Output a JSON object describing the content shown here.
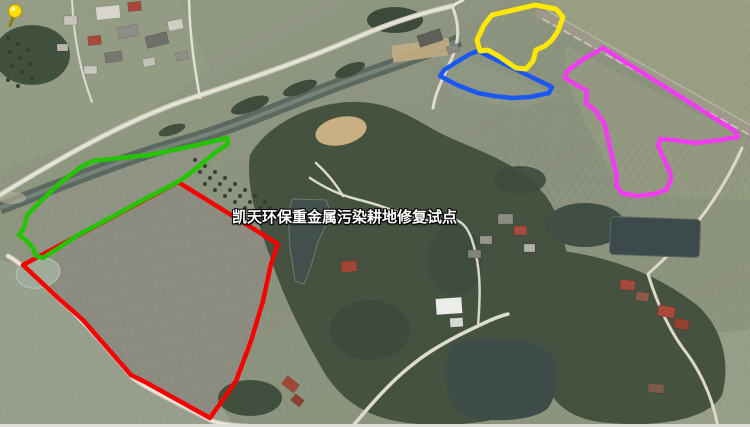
{
  "window": {
    "width": 750,
    "height": 427,
    "type": "satellite-map-screenshot"
  },
  "map": {
    "imagery": "rural aerial/satellite view with fields, forest, river, roads, ponds and villages",
    "label": {
      "text": "凯天环保重金属污染耕地修复试点",
      "text_color": "#ffffff",
      "outline_color": "#000000"
    },
    "pin": {
      "name": "site-pushpin",
      "head_color": "#ffe000",
      "stem_color": "#8a7a00"
    },
    "annotations": [
      {
        "name": "red-plot-outline",
        "color": "#f60000",
        "stroke_width": 4.5,
        "points": [
          [
            178,
            182
          ],
          [
            278,
            244
          ],
          [
            271,
            264
          ],
          [
            263,
            301
          ],
          [
            251,
            341
          ],
          [
            236,
            381
          ],
          [
            210,
            418
          ],
          [
            147,
            383
          ],
          [
            131,
            375
          ],
          [
            83,
            320
          ],
          [
            57,
            297
          ],
          [
            23,
            265
          ]
        ]
      },
      {
        "name": "green-plot-outline",
        "color": "#24c400",
        "stroke_width": 4.5,
        "points": [
          [
            227,
            138
          ],
          [
            197,
            145
          ],
          [
            150,
            155
          ],
          [
            120,
            158
          ],
          [
            93,
            161
          ],
          [
            81,
            167
          ],
          [
            60,
            183
          ],
          [
            42,
            200
          ],
          [
            27,
            215
          ],
          [
            24,
            228
          ],
          [
            19,
            235
          ],
          [
            27,
            241
          ],
          [
            33,
            248
          ],
          [
            36,
            256
          ],
          [
            43,
            258
          ],
          [
            60,
            247
          ],
          [
            78,
            235
          ],
          [
            110,
            218
          ],
          [
            143,
            200
          ],
          [
            170,
            186
          ],
          [
            181,
            180
          ],
          [
            198,
            167
          ],
          [
            216,
            152
          ],
          [
            228,
            144
          ]
        ]
      },
      {
        "name": "blue-plot-outline",
        "color": "#1b57f2",
        "stroke_width": 4.5,
        "points": [
          [
            478,
            51
          ],
          [
            552,
            87
          ],
          [
            549,
            93
          ],
          [
            530,
            97
          ],
          [
            512,
            98
          ],
          [
            494,
            96
          ],
          [
            478,
            93
          ],
          [
            457,
            85
          ],
          [
            440,
            76
          ],
          [
            444,
            70
          ],
          [
            460,
            60
          ],
          [
            470,
            54
          ]
        ]
      },
      {
        "name": "yellow-plot-outline",
        "color": "#ffe800",
        "stroke_width": 5,
        "points": [
          [
            492,
            15
          ],
          [
            535,
            5
          ],
          [
            556,
            9
          ],
          [
            563,
            17
          ],
          [
            558,
            31
          ],
          [
            552,
            40
          ],
          [
            545,
            46
          ],
          [
            536,
            50
          ],
          [
            533,
            61
          ],
          [
            526,
            69
          ],
          [
            516,
            68
          ],
          [
            500,
            57
          ],
          [
            488,
            50
          ],
          [
            480,
            51
          ],
          [
            477,
            40
          ],
          [
            484,
            25
          ]
        ]
      },
      {
        "name": "magenta-plot-outline",
        "color": "#f23cf2",
        "stroke_width": 4.5,
        "points": [
          [
            603,
            48
          ],
          [
            735,
            131
          ],
          [
            738,
            137
          ],
          [
            720,
            140
          ],
          [
            695,
            143
          ],
          [
            674,
            140
          ],
          [
            660,
            139
          ],
          [
            658,
            146
          ],
          [
            664,
            159
          ],
          [
            670,
            172
          ],
          [
            671,
            180
          ],
          [
            666,
            190
          ],
          [
            654,
            194
          ],
          [
            636,
            196
          ],
          [
            622,
            193
          ],
          [
            616,
            185
          ],
          [
            617,
            177
          ],
          [
            604,
            122
          ],
          [
            600,
            118
          ],
          [
            596,
            111
          ],
          [
            586,
            103
          ],
          [
            587,
            91
          ],
          [
            565,
            78
          ],
          [
            567,
            71
          ],
          [
            585,
            58
          ]
        ]
      }
    ]
  }
}
